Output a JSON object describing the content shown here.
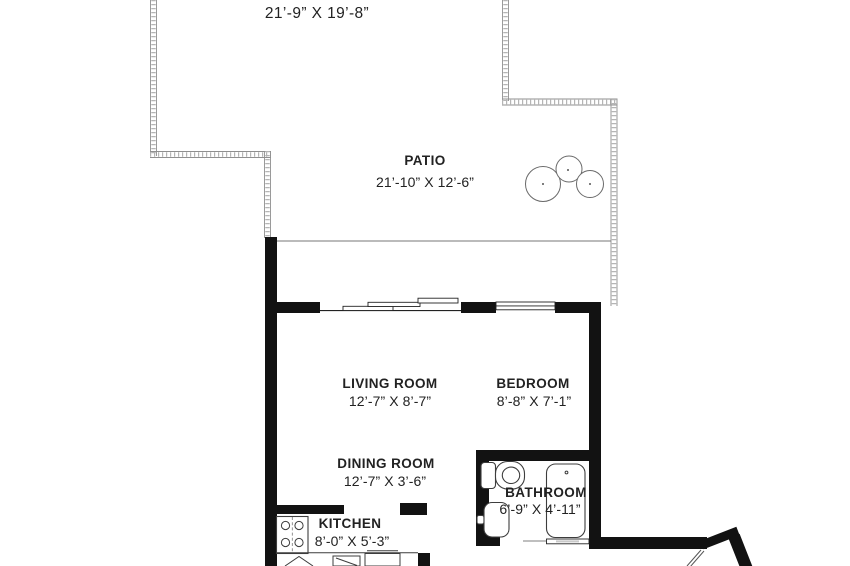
{
  "rooms": {
    "deck": {
      "dim": "21’-9” X 19’-8”"
    },
    "patio": {
      "name": "PATIO",
      "dim": "21’-10” X 12’-6”"
    },
    "living_room": {
      "name": "LIVING ROOM",
      "dim": "12’-7” X 8’-7”"
    },
    "bedroom": {
      "name": "BEDROOM",
      "dim": "8’-8” X 7’-1”"
    },
    "dining_room": {
      "name": "DINING ROOM",
      "dim": "12’-7” X 3’-6”"
    },
    "bathroom": {
      "name": "BATHROOM",
      "dim": "6’-9” X 4’-11”"
    },
    "kitchen": {
      "name": "KITCHEN",
      "dim": "8’-0” X 5’-3”"
    }
  },
  "fixtures": [
    "toilet",
    "bathroom-sink",
    "bathtub",
    "stove",
    "kitchen-counter",
    "shrub",
    "entry-door",
    "sliding-glass-door",
    "bedroom-window"
  ],
  "colors": {
    "wall": "#121212",
    "fixture_line": "#3d3d3d",
    "deck_edge": "#9a9a9a",
    "text": "#222222",
    "background": "#ffffff"
  }
}
